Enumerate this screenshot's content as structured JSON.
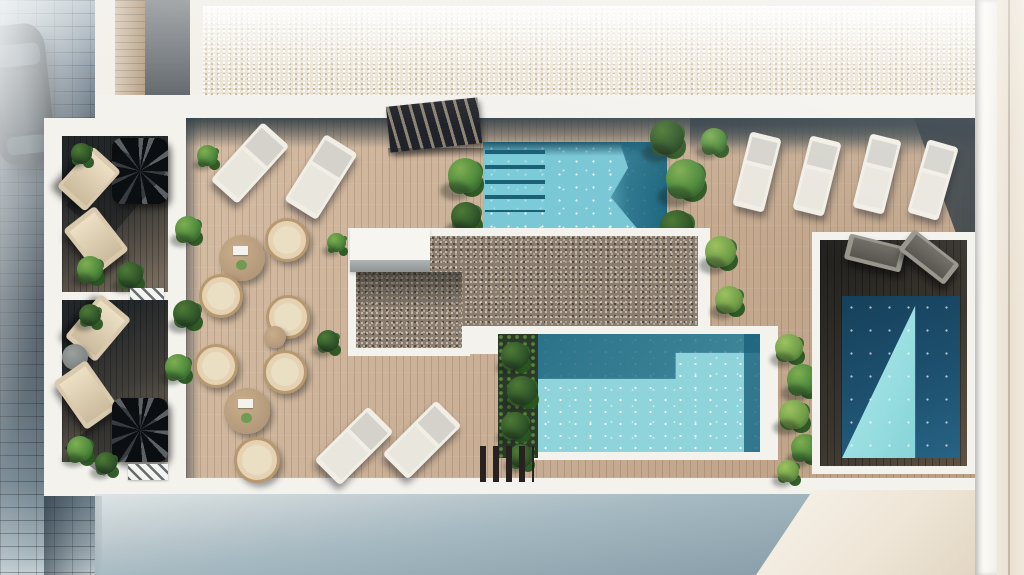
{
  "colors": {
    "deck": "#c4a88c",
    "deckDark": "#453f36",
    "white": "#f4f2ed",
    "parapet": "#36454f",
    "water1": "#7ac7d6",
    "water2": "#8ed4da",
    "gravelTop": "#eae2d2",
    "gravel": "#8a7d6e",
    "sand": "#c9b193",
    "green": "#4f8a3c",
    "greenDark": "#2c5526",
    "greenLight": "#7fae52",
    "ground1": "#a7bac2",
    "ground2": "#7f95a3",
    "wallBeige": "#eae1d2",
    "loungerW": "#f1eee6",
    "cushion": "#d4d2cb",
    "rattan": "#b8996f",
    "cushionB": "#eadec3",
    "tableWood": "#b2987a"
  },
  "scene": {
    "width": 1024,
    "height": 575,
    "objects": [
      {
        "n": "street-pavement",
        "c": "street",
        "r": [
          0,
          0,
          95,
          575
        ]
      },
      {
        "n": "parked-car",
        "c": "car",
        "r": [
          -8,
          24,
          58,
          140
        ],
        "rot": -6,
        "ch": [
          {
            "n": "car-windshield",
            "c": "car-glass",
            "r": [
              8,
              20,
              44,
              22
            ]
          },
          {
            "n": "car-roof",
            "c": "car-roof",
            "r": [
              8,
              46,
              44,
              62
            ]
          },
          {
            "n": "car-rear-window",
            "c": "car-glass2",
            "r": [
              10,
              112,
              40,
              18
            ]
          }
        ]
      },
      {
        "n": "street-fog",
        "c": "fog",
        "r": [
          0,
          0,
          95,
          575
        ]
      },
      {
        "n": "roof-walkway-wood",
        "c": "plank-v",
        "r": [
          115,
          0,
          30,
          97
        ]
      },
      {
        "n": "roof-gray-panel",
        "c": "gray-panel",
        "r": [
          145,
          0,
          45,
          98
        ]
      },
      {
        "n": "roof-gravel-area",
        "c": "gravel gravel-light",
        "r": [
          203,
          6,
          774,
          90
        ]
      },
      {
        "n": "terrace-white-base",
        "c": "white-base",
        "r": [
          95,
          95,
          890,
          401
        ]
      },
      {
        "n": "terrace-white-left",
        "c": "white-base",
        "r": [
          44,
          118,
          142,
          378
        ]
      },
      {
        "n": "main-deck",
        "c": "deck",
        "r": [
          186,
          118,
          789,
          360
        ]
      },
      {
        "n": "parapet-shadow-top",
        "c": "shade-v",
        "r": [
          186,
          118,
          789,
          30
        ]
      },
      {
        "n": "parapet-shadow-top-right",
        "c": "shade-v",
        "r": [
          690,
          118,
          285,
          38
        ]
      },
      {
        "n": "deck-left-shadow",
        "c": "shade-h",
        "r": [
          186,
          118,
          14,
          360
        ]
      },
      {
        "n": "deck-corner-shadow",
        "c": "wedge-dark",
        "r": [
          862,
          118,
          113,
          124
        ]
      },
      {
        "n": "stair-access",
        "c": "slats-dark",
        "r": [
          388,
          102,
          92,
          46
        ],
        "rot": -6
      },
      {
        "n": "stair-shadow",
        "c": "soft-shade",
        "r": [
          388,
          148,
          100,
          10
        ]
      },
      {
        "n": "pool-top",
        "c": "pool1",
        "r": [
          483,
          142,
          184,
          86
        ],
        "ch": [
          {
            "n": "pool-shadow-band",
            "c": "pool1-band",
            "r": [
              0,
              0,
              184,
              14
            ]
          },
          {
            "n": "pool-dark-corner",
            "c": "pool1-dark",
            "r": [
              112,
              0,
              72,
              86
            ]
          },
          {
            "n": "pool-steps",
            "c": "pool-steps",
            "r": [
              2,
              8,
              60,
              62
            ]
          }
        ]
      },
      {
        "n": "plant",
        "c": "plant",
        "r": [
          446,
          156,
          40,
          40
        ]
      },
      {
        "n": "plant",
        "c": "plant plant-d",
        "r": [
          450,
          200,
          34,
          34
        ]
      },
      {
        "n": "plant",
        "c": "plant plant-d",
        "r": [
          648,
          118,
          40,
          40
        ]
      },
      {
        "n": "plant",
        "c": "plant",
        "r": [
          664,
          156,
          46,
          46
        ]
      },
      {
        "n": "plant",
        "c": "plant plant-d",
        "r": [
          658,
          208,
          40,
          40
        ]
      },
      {
        "n": "plant",
        "c": "plant",
        "r": [
          700,
          126,
          30,
          30
        ]
      },
      {
        "n": "gravel-border",
        "c": "white-base",
        "r": [
          348,
          228,
          362,
          126
        ]
      },
      {
        "n": "gravel-border",
        "c": "white-base",
        "r": [
          348,
          264,
          122,
          92
        ]
      },
      {
        "n": "gravel-center",
        "c": "gravel",
        "r": [
          430,
          236,
          268,
          90
        ]
      },
      {
        "n": "gravel-center",
        "c": "gravel",
        "r": [
          356,
          272,
          106,
          76
        ]
      },
      {
        "n": "gravel-shadow",
        "c": "soft-shade2",
        "r": [
          356,
          272,
          106,
          34
        ]
      },
      {
        "n": "skylight-box",
        "c": "white-box",
        "r": [
          350,
          228,
          80,
          44
        ],
        "ch": [
          {
            "n": "skylight-edge",
            "c": "gray-strip",
            "r": [
              0,
              32,
              80,
              12
            ]
          }
        ]
      },
      {
        "n": "pool-border",
        "c": "white-base",
        "r": [
          528,
          326,
          250,
          134
        ]
      },
      {
        "n": "pool-main",
        "c": "pool2",
        "r": [
          538,
          334,
          222,
          118
        ]
      },
      {
        "n": "planter-bed",
        "c": "bed-dark",
        "r": [
          498,
          334,
          40,
          124
        ]
      },
      {
        "n": "plant",
        "c": "plant plant-d",
        "r": [
          500,
          340,
          32,
          32
        ]
      },
      {
        "n": "plant",
        "c": "plant plant-d",
        "r": [
          506,
          374,
          34,
          34
        ]
      },
      {
        "n": "plant",
        "c": "plant plant-d",
        "r": [
          500,
          410,
          32,
          32
        ]
      },
      {
        "n": "plant",
        "c": "plant plant-d",
        "r": [
          508,
          442,
          28,
          28
        ]
      },
      {
        "n": "pool-steps-slats",
        "c": "slats-dark2",
        "r": [
          480,
          446,
          54,
          36
        ]
      },
      {
        "n": "plant",
        "c": "plant plant-l",
        "r": [
          774,
          332,
          32,
          32
        ]
      },
      {
        "n": "plant",
        "c": "plant",
        "r": [
          786,
          362,
          36,
          36
        ]
      },
      {
        "n": "plant",
        "c": "plant plant-l",
        "r": [
          778,
          398,
          34,
          34
        ]
      },
      {
        "n": "plant",
        "c": "plant",
        "r": [
          790,
          432,
          32,
          32
        ]
      },
      {
        "n": "plant",
        "c": "plant plant-l",
        "r": [
          776,
          458,
          26,
          26
        ]
      },
      {
        "n": "private-terrace-border",
        "c": "white-base",
        "r": [
          812,
          232,
          163,
          242
        ]
      },
      {
        "n": "private-terrace-deck",
        "c": "deck-dark",
        "r": [
          820,
          240,
          147,
          226
        ]
      },
      {
        "n": "private-pool",
        "c": "pool3",
        "r": [
          842,
          296,
          118,
          162
        ]
      },
      {
        "n": "sun-lounger-gray",
        "c": "lounger-gray",
        "r": [
          846,
          240,
          58,
          26
        ],
        "rot": 14
      },
      {
        "n": "sun-lounger-gray",
        "c": "lounger-gray",
        "r": [
          900,
          244,
          58,
          26
        ],
        "rot": 38
      },
      {
        "n": "balcony-deck",
        "c": "deck-shade",
        "r": [
          62,
          136,
          106,
          156
        ]
      },
      {
        "n": "spiral-stair",
        "c": "spiral",
        "r": [
          112,
          138,
          56,
          66
        ]
      },
      {
        "n": "spiral-stair-shadow",
        "c": "spiral-shade",
        "r": [
          66,
          150,
          100,
          92
        ]
      },
      {
        "n": "sun-lounger-beige",
        "c": "lounger-beige",
        "r": [
          70,
          152,
          38,
          54
        ],
        "rot": 42
      },
      {
        "n": "sun-lounger-beige",
        "c": "lounger-beige",
        "r": [
          76,
          212,
          40,
          56
        ],
        "rot": -38
      },
      {
        "n": "plant",
        "c": "plant plant-d",
        "r": [
          70,
          142,
          24,
          24
        ]
      },
      {
        "n": "plant",
        "c": "plant",
        "r": [
          76,
          254,
          30,
          30
        ]
      },
      {
        "n": "plant",
        "c": "plant plant-d",
        "r": [
          116,
          260,
          30,
          30
        ]
      },
      {
        "n": "vent-grate",
        "c": "hatch",
        "r": [
          130,
          288,
          34,
          12
        ]
      },
      {
        "n": "balcony-deck",
        "c": "deck-shade",
        "r": [
          62,
          300,
          106,
          162
        ]
      },
      {
        "n": "sun-lounger-beige",
        "c": "lounger-beige",
        "r": [
          78,
          300,
          40,
          56
        ],
        "rot": 40
      },
      {
        "n": "side-table",
        "c": "table-gray",
        "r": [
          62,
          344,
          26,
          26
        ]
      },
      {
        "n": "sun-lounger-beige",
        "c": "lounger-beige",
        "r": [
          66,
          366,
          40,
          58
        ],
        "rot": -35
      },
      {
        "n": "spiral-stair",
        "c": "spiral",
        "r": [
          112,
          398,
          56,
          64
        ]
      },
      {
        "n": "spiral-stair-shadow",
        "c": "spiral-shade",
        "r": [
          64,
          406,
          100,
          70
        ]
      },
      {
        "n": "plant",
        "c": "plant plant-d",
        "r": [
          78,
          302,
          26,
          26
        ]
      },
      {
        "n": "plant",
        "c": "plant",
        "r": [
          66,
          434,
          30,
          30
        ]
      },
      {
        "n": "plant",
        "c": "plant plant-d",
        "r": [
          94,
          450,
          26,
          26
        ]
      },
      {
        "n": "vent-grate",
        "c": "hatch",
        "r": [
          128,
          464,
          40,
          16
        ]
      },
      {
        "n": "sun-lounger",
        "c": "lounger-white",
        "r": [
          232,
          124,
          36,
          78
        ],
        "rot": 42
      },
      {
        "n": "sun-lounger",
        "c": "lounger-white",
        "r": [
          302,
          138,
          38,
          78
        ],
        "rot": 32
      },
      {
        "n": "sun-lounger",
        "c": "lounger-white",
        "r": [
          741,
          134,
          32,
          76
        ],
        "rot": 14
      },
      {
        "n": "sun-lounger",
        "c": "lounger-white",
        "r": [
          801,
          138,
          32,
          76
        ],
        "rot": 14
      },
      {
        "n": "sun-lounger",
        "c": "lounger-white",
        "r": [
          861,
          136,
          32,
          76
        ],
        "rot": 14
      },
      {
        "n": "sun-lounger",
        "c": "lounger-white",
        "r": [
          917,
          142,
          32,
          76
        ],
        "rot": 16
      },
      {
        "n": "dining-table",
        "c": "table",
        "r": [
          219,
          235,
          46,
          46
        ]
      },
      {
        "n": "rattan-chair",
        "c": "chair",
        "r": [
          265,
          218,
          44,
          44
        ]
      },
      {
        "n": "rattan-chair",
        "c": "chair",
        "r": [
          199,
          274,
          44,
          44
        ]
      },
      {
        "n": "rattan-chair",
        "c": "chair",
        "r": [
          266,
          295,
          44,
          44
        ]
      },
      {
        "n": "plant",
        "c": "plant",
        "r": [
          326,
          232,
          22,
          22
        ]
      },
      {
        "n": "plant",
        "c": "plant",
        "r": [
          174,
          214,
          30,
          30
        ]
      },
      {
        "n": "plant",
        "c": "plant plant-d",
        "r": [
          172,
          298,
          32,
          32
        ]
      },
      {
        "n": "plant",
        "c": "plant",
        "r": [
          164,
          352,
          30,
          30
        ]
      },
      {
        "n": "plant",
        "c": "plant plant-d",
        "r": [
          316,
          328,
          26,
          26
        ]
      },
      {
        "n": "plant",
        "c": "plant",
        "r": [
          196,
          144,
          24,
          24
        ]
      },
      {
        "n": "side-table",
        "c": "table-plain",
        "r": [
          264,
          326,
          22,
          22
        ]
      },
      {
        "n": "rattan-chair",
        "c": "chair",
        "r": [
          194,
          344,
          44,
          44
        ]
      },
      {
        "n": "rattan-chair",
        "c": "chair",
        "r": [
          263,
          350,
          44,
          44
        ]
      },
      {
        "n": "dining-table",
        "c": "table",
        "r": [
          224,
          388,
          46,
          46
        ]
      },
      {
        "n": "rattan-chair",
        "c": "chair",
        "r": [
          234,
          437,
          46,
          46
        ]
      },
      {
        "n": "sun-lounger",
        "c": "lounger-white",
        "r": [
          336,
          408,
          36,
          76
        ],
        "rot": 45
      },
      {
        "n": "sun-lounger",
        "c": "lounger-white",
        "r": [
          404,
          402,
          36,
          76
        ],
        "rot": 45
      },
      {
        "n": "plant",
        "c": "plant plant-l",
        "r": [
          704,
          234,
          36,
          36
        ]
      },
      {
        "n": "plant",
        "c": "plant plant-l",
        "r": [
          714,
          284,
          32,
          32
        ]
      },
      {
        "n": "ground-shadow",
        "c": "ground",
        "r": [
          95,
          494,
          929,
          81
        ]
      },
      {
        "n": "ground-sunlit",
        "c": "ground-light",
        "r": [
          756,
          490,
          219,
          85
        ]
      },
      {
        "n": "street-shadow-bottom",
        "c": "shade-street",
        "r": [
          44,
          496,
          58,
          79
        ]
      },
      {
        "n": "wall-white",
        "c": "wall-w",
        "r": [
          975,
          0,
          22,
          575
        ]
      },
      {
        "n": "wall-beige",
        "c": "wall-b",
        "r": [
          997,
          0,
          27,
          575
        ]
      },
      {
        "n": "sun-haze",
        "c": "haze",
        "r": [
          0,
          0,
          1024,
          575
        ]
      }
    ]
  }
}
